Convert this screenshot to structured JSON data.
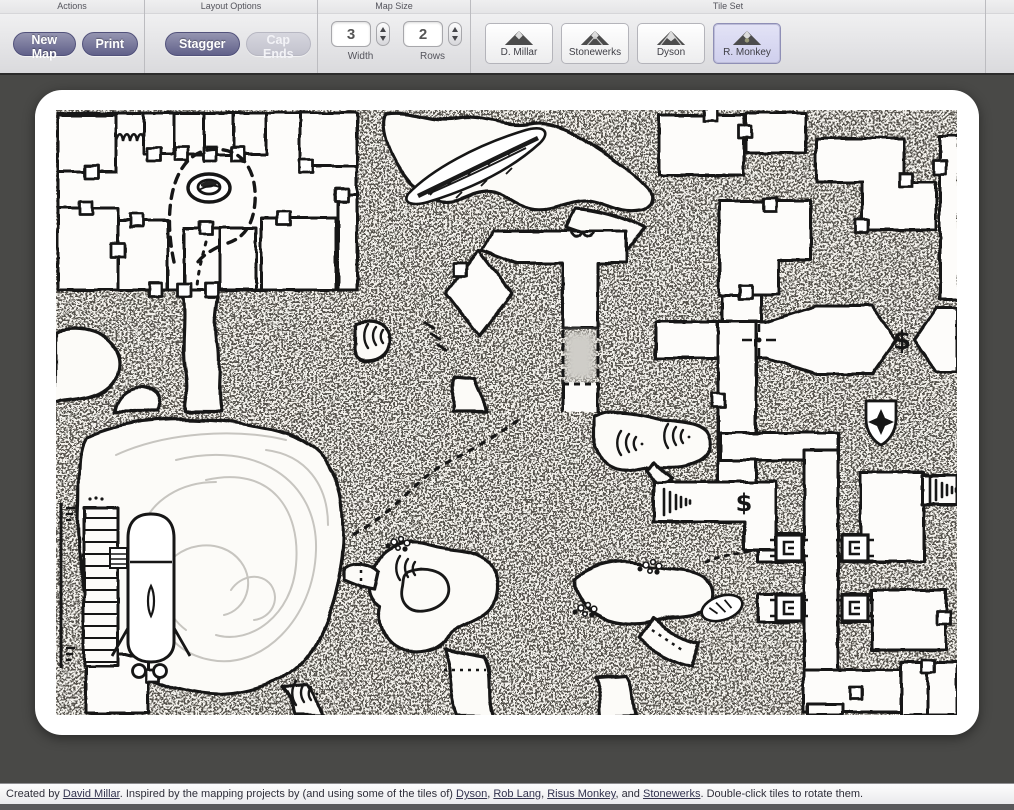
{
  "toolbar": {
    "sections": {
      "actions": "Actions",
      "layout_options": "Layout Options",
      "map_size": "Map Size",
      "tile_set": "Tile Set"
    },
    "buttons": {
      "new_map": "New Map",
      "print": "Print",
      "stagger": "Stagger",
      "cap_ends": "Cap Ends"
    },
    "map_size": {
      "width_value": "3",
      "width_label": "Width",
      "rows_value": "2",
      "rows_label": "Rows"
    },
    "tile_sets": [
      {
        "label": "D. Millar",
        "selected": false
      },
      {
        "label": "Stonewerks",
        "selected": false
      },
      {
        "label": "Dyson",
        "selected": false
      },
      {
        "label": "R. Monkey",
        "selected": true
      }
    ]
  },
  "map": {
    "treasure_glyph": "$",
    "features": [
      "rooms-with-doors",
      "patrol-path-around-pit",
      "chasm-crevasse",
      "diamond-room",
      "octagon-treasure-room",
      "shield-star-emblem",
      "water-cavern-with-boat",
      "dock-pier",
      "organic-cave-passages",
      "portcullis-doors",
      "stairs",
      "secret-door-marker"
    ]
  },
  "footer": {
    "segments": [
      {
        "text": "Created by ",
        "link": false
      },
      {
        "text": "David Millar",
        "link": true
      },
      {
        "text": ". Inspired by the mapping projects by (and using some of the tiles of) ",
        "link": false
      },
      {
        "text": "Dyson",
        "link": true
      },
      {
        "text": ", ",
        "link": false
      },
      {
        "text": "Rob Lang",
        "link": true
      },
      {
        "text": ", ",
        "link": false
      },
      {
        "text": "Risus Monkey",
        "link": true
      },
      {
        "text": ", and ",
        "link": false
      },
      {
        "text": "Stonewerks",
        "link": true
      },
      {
        "text": ". Double-click tiles to rotate them.",
        "link": false
      }
    ]
  },
  "colors": {
    "button_purple": "#61618a",
    "button_disabled": "#c9c9d4",
    "tileset_selected_bg": "#d8d8f2",
    "stage_background": "#494947",
    "stipple_ink": "#56534d",
    "map_ink": "#161616"
  }
}
